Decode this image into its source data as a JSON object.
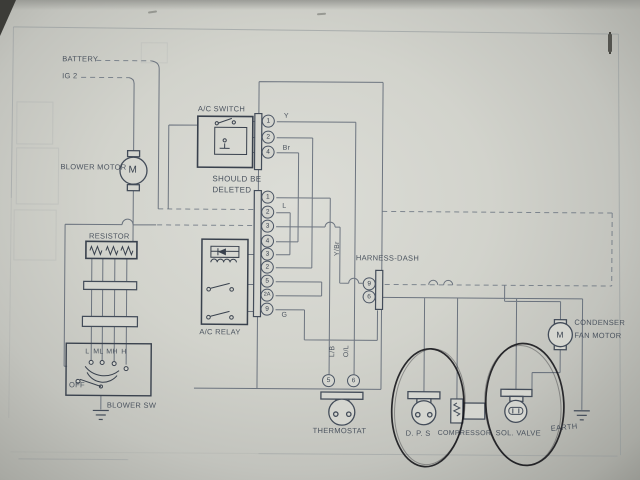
{
  "labels": {
    "battery": "BATTERY",
    "ignition": "IG 2",
    "blower_motor": "BLOWER MOTOR",
    "motor_letter": "M",
    "ac_switch": "A/C SWITCH",
    "note_line1": "SHOULD BE",
    "note_line2": "DELETED",
    "resistor": "RESISTOR",
    "ac_relay": "A/C RELAY",
    "blower_sw": "BLOWER SW",
    "off": "OFF",
    "speed_l": "L",
    "speed_ml": "ML",
    "speed_mh": "MH",
    "speed_h": "H",
    "harness_dash": "HARNESS-DASH",
    "thermostat": "THERMOSTAT",
    "dps": "D. P. S",
    "compressor": "COMPRESSOR",
    "sol_valve": "SOL. VALVE",
    "earth": "EARTH",
    "condenser_line1": "CONDENSER",
    "condenser_line2": "FAN MOTOR"
  },
  "wire_labels": {
    "y": "Y",
    "br": "Br",
    "l": "L",
    "g": "G",
    "y_br": "Y/Br",
    "l_b": "L/B",
    "o_l": "O/L"
  },
  "pins": {
    "ac_switch_connector": [
      "1",
      "2",
      "4"
    ],
    "main_connector": [
      "1",
      "2",
      "3",
      "4",
      "3",
      "2",
      "5",
      "2A",
      "9"
    ],
    "harness_dash_connector": [
      "9",
      "6"
    ],
    "thermostat_connector": [
      "5",
      "6"
    ]
  },
  "annotations": {
    "hand_circled": [
      "D. P. S",
      "SOL. VALVE"
    ]
  },
  "colors": {
    "paper": "#d2d3cc",
    "ink_line": "#5b6472",
    "ink_text": "#3f4855",
    "box_ink": "#39414d",
    "annotation_ink": "#17171c"
  }
}
